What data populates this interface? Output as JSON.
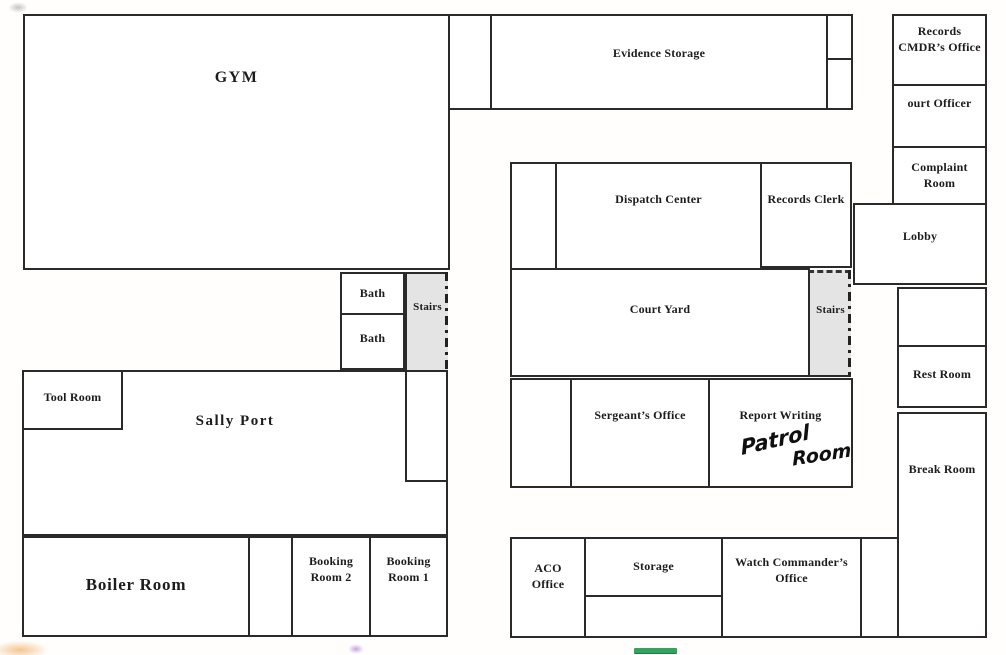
{
  "rooms": {
    "gym": {
      "label": "GYM"
    },
    "evidence_storage": {
      "label": "Evidence Storage"
    },
    "records_cmdr_office": {
      "label": "Records\nCMDR’s Office"
    },
    "court_officer": {
      "label": "ourt Officer"
    },
    "complaint_room": {
      "label": "Complaint\nRoom"
    },
    "lobby": {
      "label": "Lobby"
    },
    "dispatch_center": {
      "label": "Dispatch Center"
    },
    "records_clerk": {
      "label": "Records Clerk"
    },
    "court_yard": {
      "label": "Court Yard"
    },
    "stairs_left": {
      "label": "Stairs"
    },
    "stairs_right": {
      "label": "Stairs"
    },
    "bath_upper": {
      "label": "Bath"
    },
    "bath_lower": {
      "label": "Bath"
    },
    "tool_room": {
      "label": "Tool Room"
    },
    "sally_port": {
      "label": "Sally Port"
    },
    "sergeants_office": {
      "label": "Sergeant’s Office"
    },
    "report_writing": {
      "label": "Report Writing"
    },
    "rest_room": {
      "label": "Rest Room"
    },
    "break_room": {
      "label": "Break Room"
    },
    "boiler_room": {
      "label": "Boiler Room"
    },
    "booking_room_2": {
      "label": "Booking\nRoom 2"
    },
    "booking_room_1": {
      "label": "Booking\nRoom 1"
    },
    "aco_office": {
      "label": "ACO\nOffice"
    },
    "storage": {
      "label": "Storage"
    },
    "watch_commanders_office": {
      "label": "Watch Commander’s\nOffice"
    }
  },
  "handwriting": {
    "text": "Patrol Room",
    "word1": "Patrol",
    "word2": "Room"
  },
  "colors": {
    "wall": "#2a2a2a",
    "stairs_fill": "#e4e4e4",
    "green_mark": "#35a25f",
    "orange_mark": "#f3c68f",
    "purple_mark": "#c9a3e0"
  }
}
